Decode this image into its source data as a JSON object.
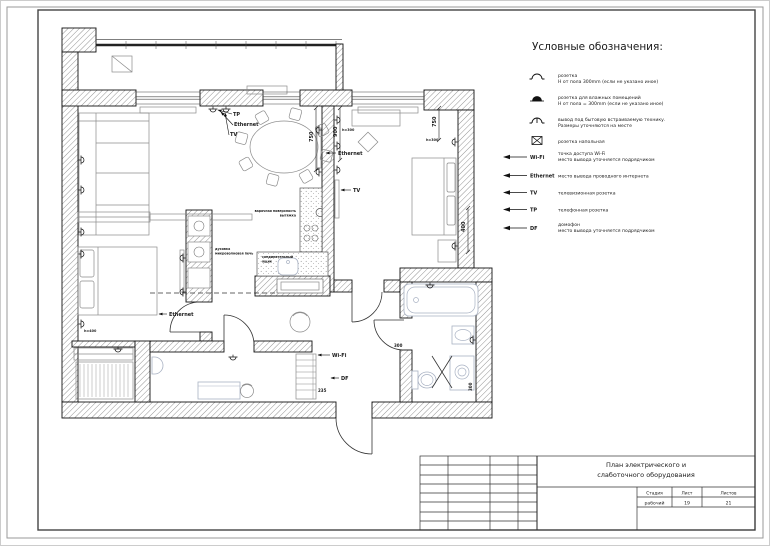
{
  "legend": {
    "title": "Условные обозначения:",
    "symbol_items": [
      {
        "icon": "socket-icon",
        "line1": "розетка",
        "line2": "Н от пола 300mm (если не указано иное)"
      },
      {
        "icon": "wet-socket-icon",
        "line1": "розетка для влажных помещений",
        "line2": "Н от пола = 300mm (если не указано иное)"
      },
      {
        "icon": "appliance-outlet-icon",
        "line1": "вывод под бытовую встраиваемую технику.",
        "line2": "Размеры уточняются на месте"
      },
      {
        "icon": "floor-socket-icon",
        "line1": "розетка напольная",
        "line2": ""
      }
    ],
    "arrow_items": [
      {
        "label": "Wi-Fi",
        "line1": "точка доступа Wi-Fi",
        "line2": "место вывода уточняется подрядчиком"
      },
      {
        "label": "Ethernet",
        "line1": "место вывода проводного интернета",
        "line2": ""
      },
      {
        "label": "TV",
        "line1": "телевизионная розетка",
        "line2": ""
      },
      {
        "label": "TP",
        "line1": "телефонная розетка",
        "line2": ""
      },
      {
        "label": "DF",
        "line1": "домофон",
        "line2": "место вывода уточняется подрядчиком"
      }
    ]
  },
  "title_block": {
    "title_line1": "План электрического и",
    "title_line2": "слаботочного оборудования",
    "stage_header": "Стадия",
    "sheet_header": "Лист",
    "sheets_header": "Листов",
    "stage_value": "рабочий",
    "sheet_value": "19",
    "sheets_value": "21"
  },
  "plan": {
    "labels": [
      {
        "text": "TP",
        "x": 233,
        "y": 116
      },
      {
        "text": "Ethernet",
        "x": 234,
        "y": 126
      },
      {
        "text": "TV",
        "x": 230,
        "y": 136
      },
      {
        "text": "Ethernet",
        "x": 338,
        "y": 155
      },
      {
        "text": "TV",
        "x": 353,
        "y": 192
      },
      {
        "text": "Ethernet",
        "x": 169,
        "y": 316
      },
      {
        "text": "Wi-Fi",
        "x": 332,
        "y": 357
      },
      {
        "text": "DF",
        "x": 341,
        "y": 380
      },
      {
        "text": "750",
        "x": 313,
        "y": 142,
        "rot": -90
      },
      {
        "text": "900",
        "x": 337,
        "y": 137,
        "rot": -90
      },
      {
        "text": "750",
        "x": 436,
        "y": 127,
        "rot": -90
      },
      {
        "text": "400",
        "x": 465,
        "y": 232,
        "rot": -90
      },
      {
        "text": "h=300",
        "x": 426,
        "y": 141,
        "size": 3.4
      },
      {
        "text": "h=300",
        "x": 342,
        "y": 131,
        "size": 3.4
      },
      {
        "text": "h=400",
        "x": 84,
        "y": 332,
        "size": 3.4
      },
      {
        "text": "300",
        "x": 394,
        "y": 347,
        "size": 4
      },
      {
        "text": "235",
        "x": 318,
        "y": 392,
        "size": 4
      },
      {
        "text": "300",
        "x": 472,
        "y": 391,
        "size": 4,
        "rot": -90
      },
      {
        "text": "варочная поверхность",
        "x": 296,
        "y": 212,
        "size": 3.2,
        "anchor": "end"
      },
      {
        "text": "вытяжка",
        "x": 296,
        "y": 216.5,
        "size": 3.2,
        "anchor": "end"
      },
      {
        "text": "духовка",
        "x": 215,
        "y": 250,
        "size": 3.2
      },
      {
        "text": "микроволновая печь",
        "x": 215,
        "y": 254.5,
        "size": 3.2
      },
      {
        "text": "соединительный",
        "x": 262,
        "y": 258,
        "size": 3.2
      },
      {
        "text": "ящик",
        "x": 262,
        "y": 262.5,
        "size": 3.2
      }
    ],
    "sockets": [
      [
        213,
        109,
        180
      ],
      [
        226,
        109,
        180
      ],
      [
        81,
        160,
        90
      ],
      [
        81,
        190,
        90
      ],
      [
        81,
        232,
        90
      ],
      [
        81,
        254,
        90
      ],
      [
        81,
        324,
        90
      ],
      [
        183,
        258,
        -90
      ],
      [
        183,
        292,
        -90
      ],
      [
        319,
        130,
        -90
      ],
      [
        319,
        172,
        -90
      ],
      [
        337,
        120,
        90
      ],
      [
        337,
        146,
        90
      ],
      [
        337,
        170,
        90
      ],
      [
        455,
        142,
        -90
      ],
      [
        455,
        246,
        -90
      ],
      [
        430,
        285,
        180
      ],
      [
        473,
        340,
        -90
      ],
      [
        118,
        349,
        180
      ],
      [
        233,
        357,
        180
      ]
    ],
    "leaders": [
      [
        232,
        114,
        218,
        110
      ],
      [
        233,
        125,
        221,
        112
      ],
      [
        229,
        135,
        225,
        113
      ],
      [
        336,
        153,
        326,
        153
      ],
      [
        351,
        190,
        341,
        190
      ],
      [
        167,
        314,
        159,
        314
      ],
      [
        330,
        355,
        318,
        355
      ],
      [
        339,
        378,
        331,
        378
      ]
    ]
  }
}
